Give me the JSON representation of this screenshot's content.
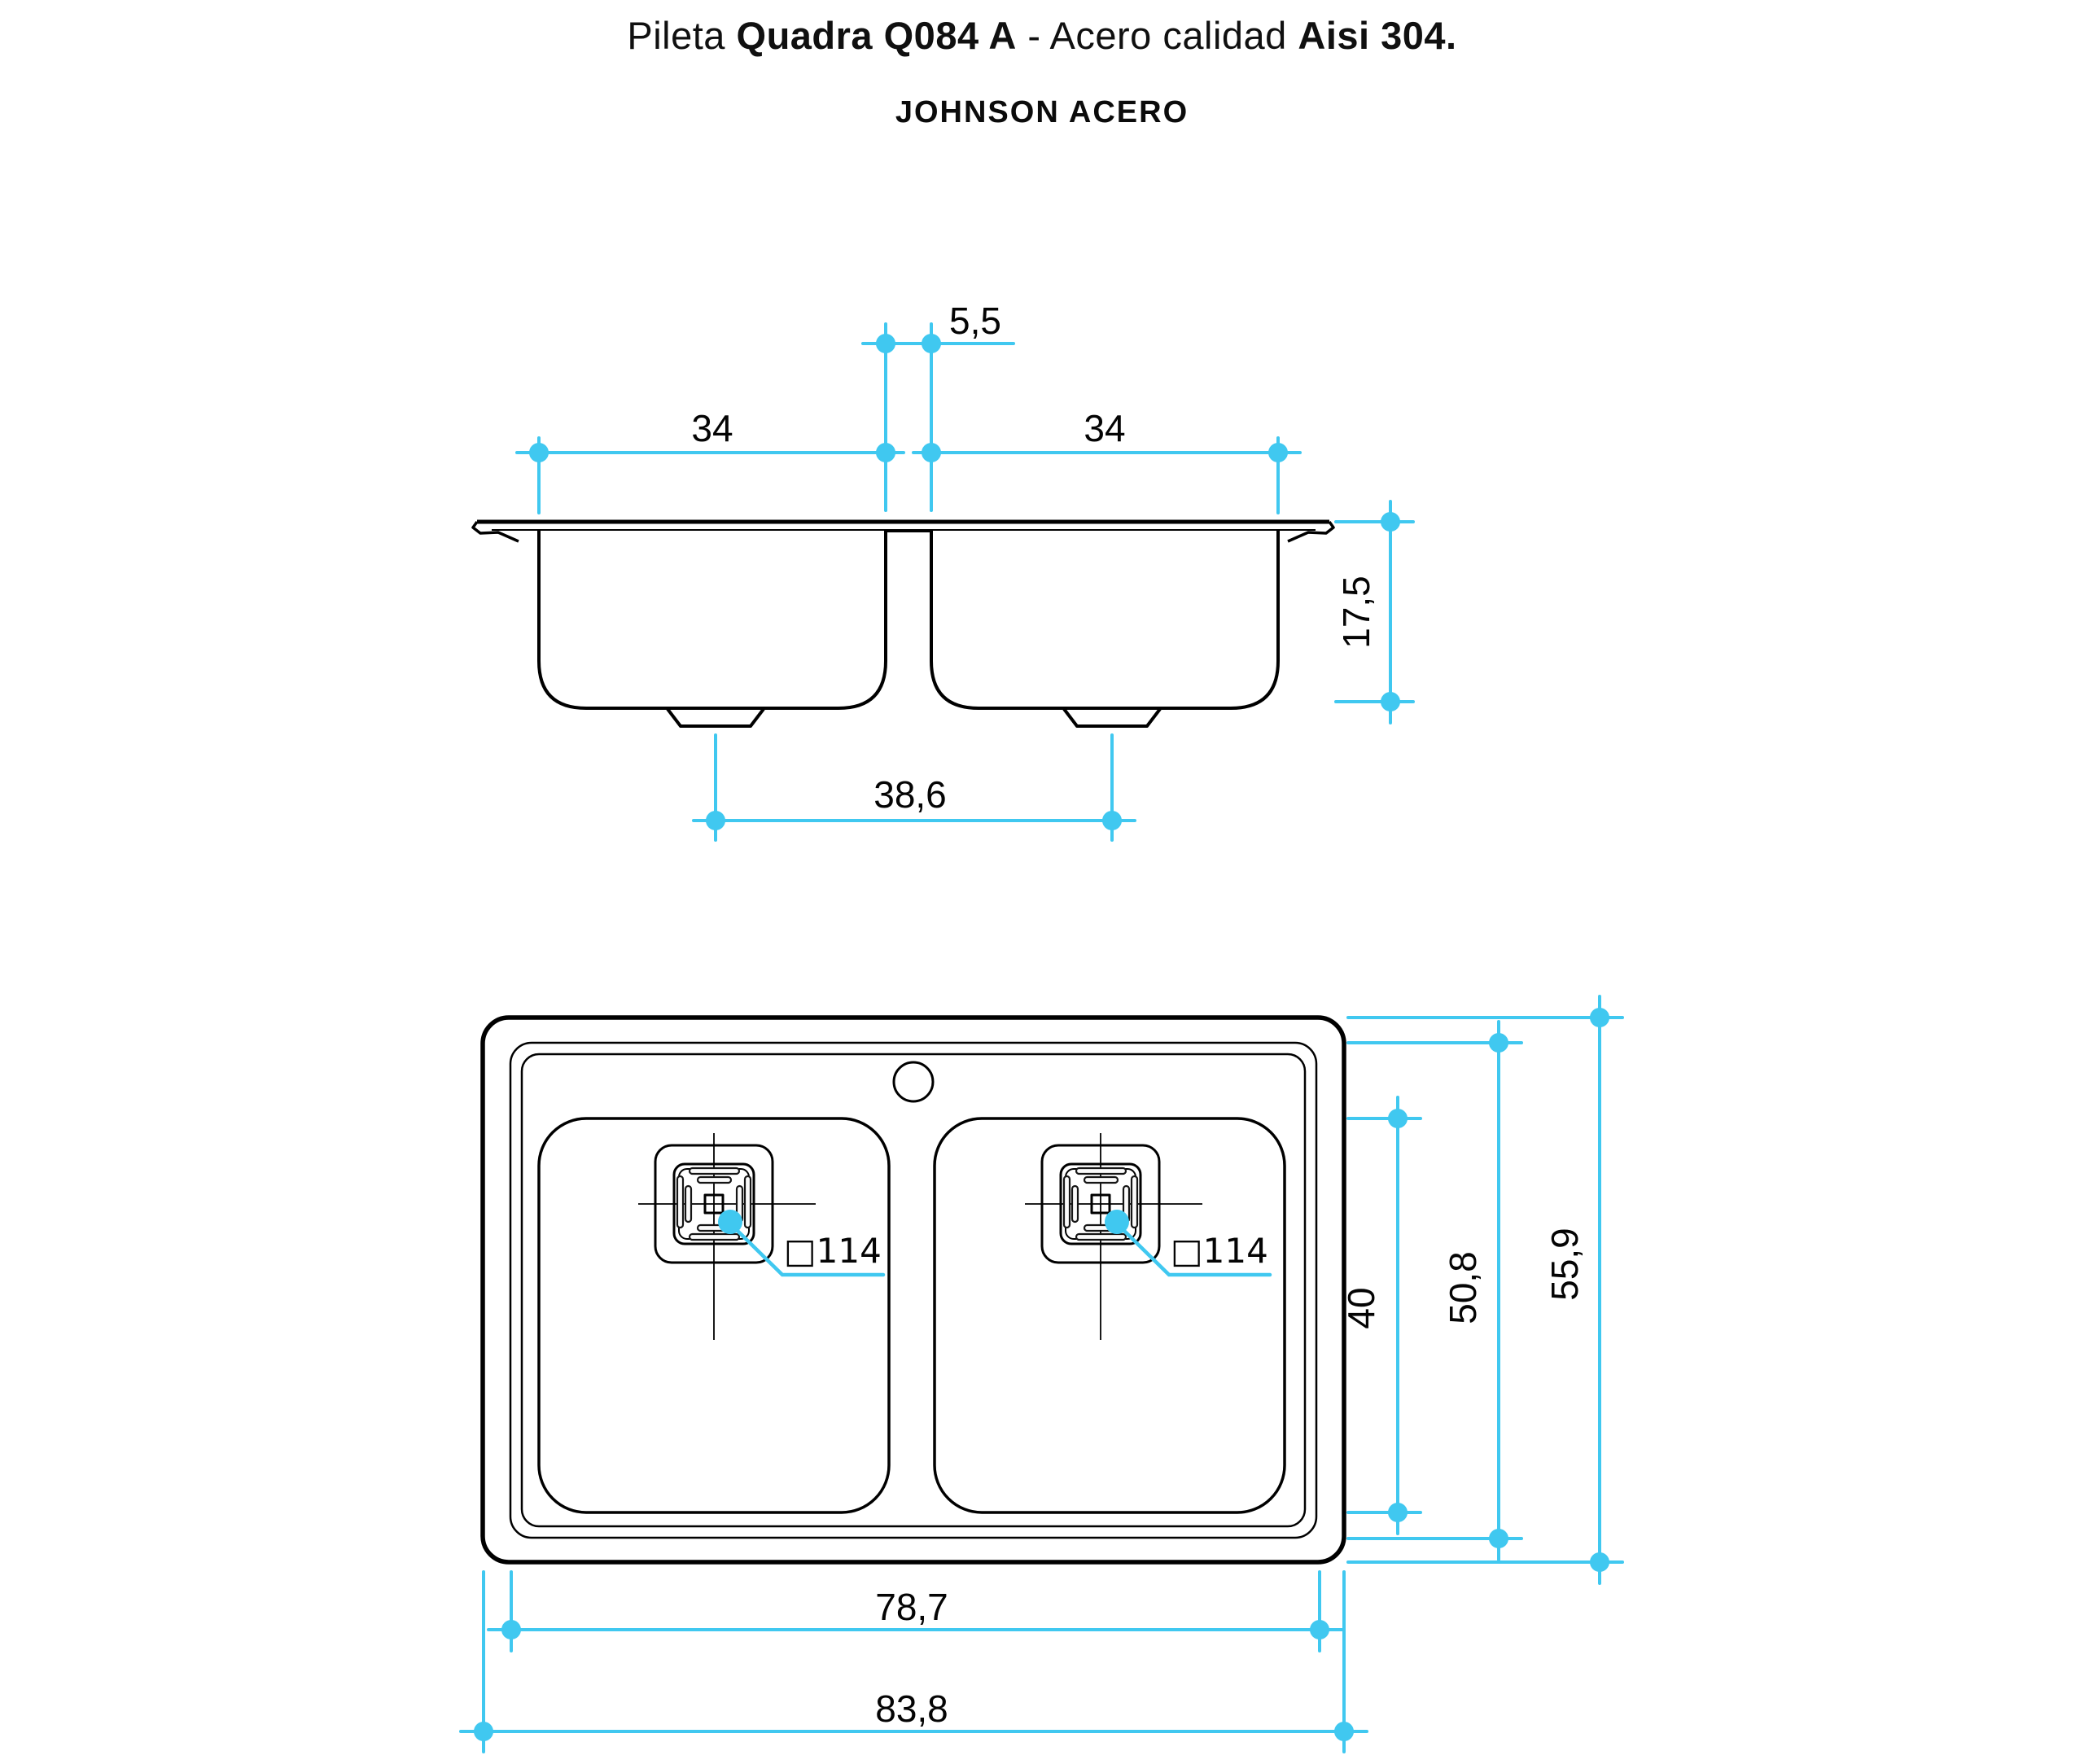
{
  "header": {
    "title": {
      "part1": "Pileta ",
      "part2": "Quadra Q084 A",
      "part3": " - Acero calidad ",
      "part4": "Aisi 304."
    },
    "brand": "JOHNSON ACERO"
  },
  "colors": {
    "dimension_accent": "#40c8f0",
    "line": "#000000",
    "background": "#ffffff"
  },
  "elevation_view": {
    "description": "front section view of double-bowl sink",
    "dims": {
      "center_gap": "5,5",
      "left_bowl_width": "34",
      "right_bowl_width": "34",
      "depth": "17,5",
      "drain_spacing": "38,6"
    }
  },
  "plan_view": {
    "description": "top view of double-bowl sink",
    "dims": {
      "left_drain_size": "□114",
      "right_drain_size": "□114",
      "bowl_length": "40",
      "inner_length": "50,8",
      "overall_length": "55,9",
      "inner_width": "78,7",
      "overall_width": "83,8"
    }
  }
}
